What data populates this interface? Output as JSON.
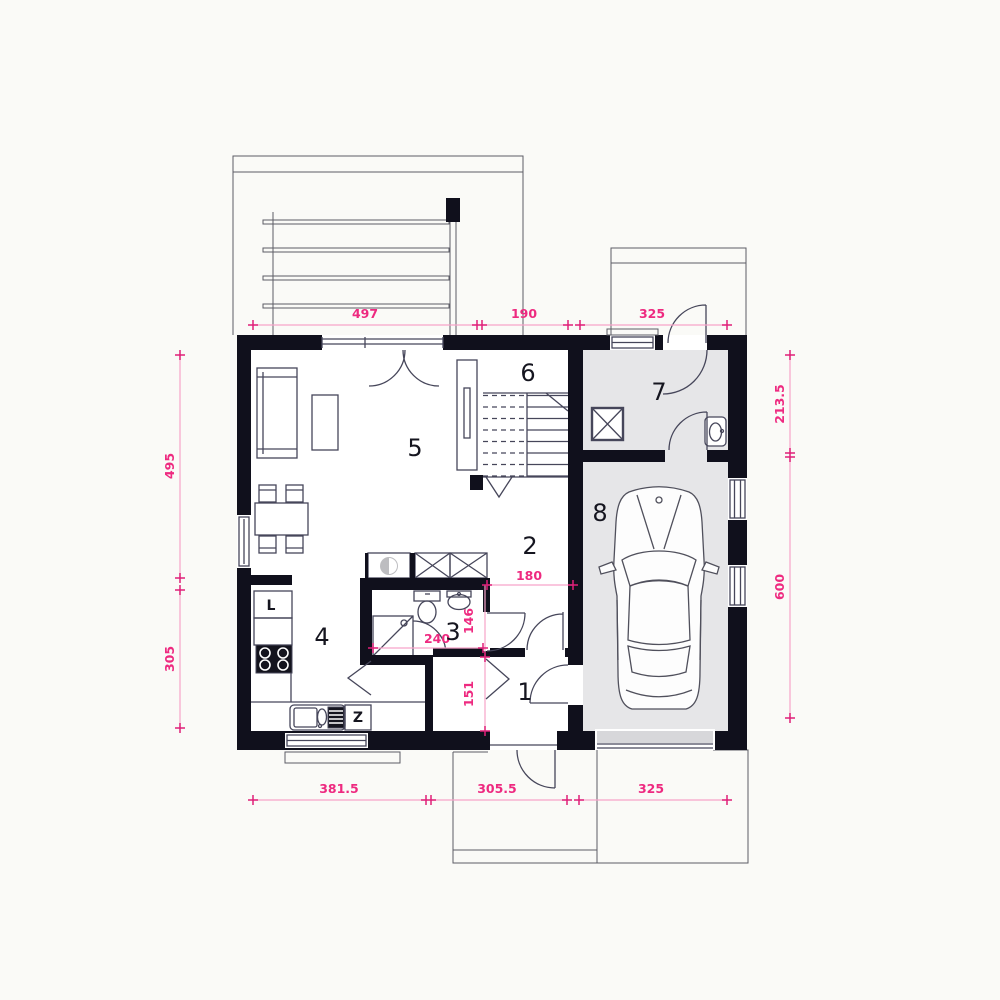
{
  "plan": {
    "colors": {
      "bg": "#fafaf7",
      "wall": "#10101c",
      "line": "#46465a",
      "thin": "#5c5c66",
      "floor-gray": "#e6e6e8",
      "door-gray": "#d7d7da",
      "appliance-gray": "#bdbdc0",
      "dim-line": "#f6a3c9",
      "dim-tick": "#e01f78",
      "dim-text": "#ee2a80",
      "label": "#15151f"
    },
    "rooms": [
      {
        "number": "1"
      },
      {
        "number": "2"
      },
      {
        "number": "3"
      },
      {
        "number": "4"
      },
      {
        "number": "5"
      },
      {
        "number": "6"
      },
      {
        "number": "7"
      },
      {
        "number": "8"
      }
    ],
    "appliances": {
      "fridge": "L",
      "sink_unit": "Z"
    },
    "dimensions": {
      "top": [
        "497",
        "190",
        "325"
      ],
      "bottom": [
        "381.5",
        "305.5",
        "325"
      ],
      "left": [
        "495",
        "305"
      ],
      "right": [
        "213.5",
        "600"
      ],
      "interior": {
        "hall_width": "180",
        "bath_depth": "146",
        "bath_width": "240",
        "corridor_depth": "151"
      }
    }
  }
}
